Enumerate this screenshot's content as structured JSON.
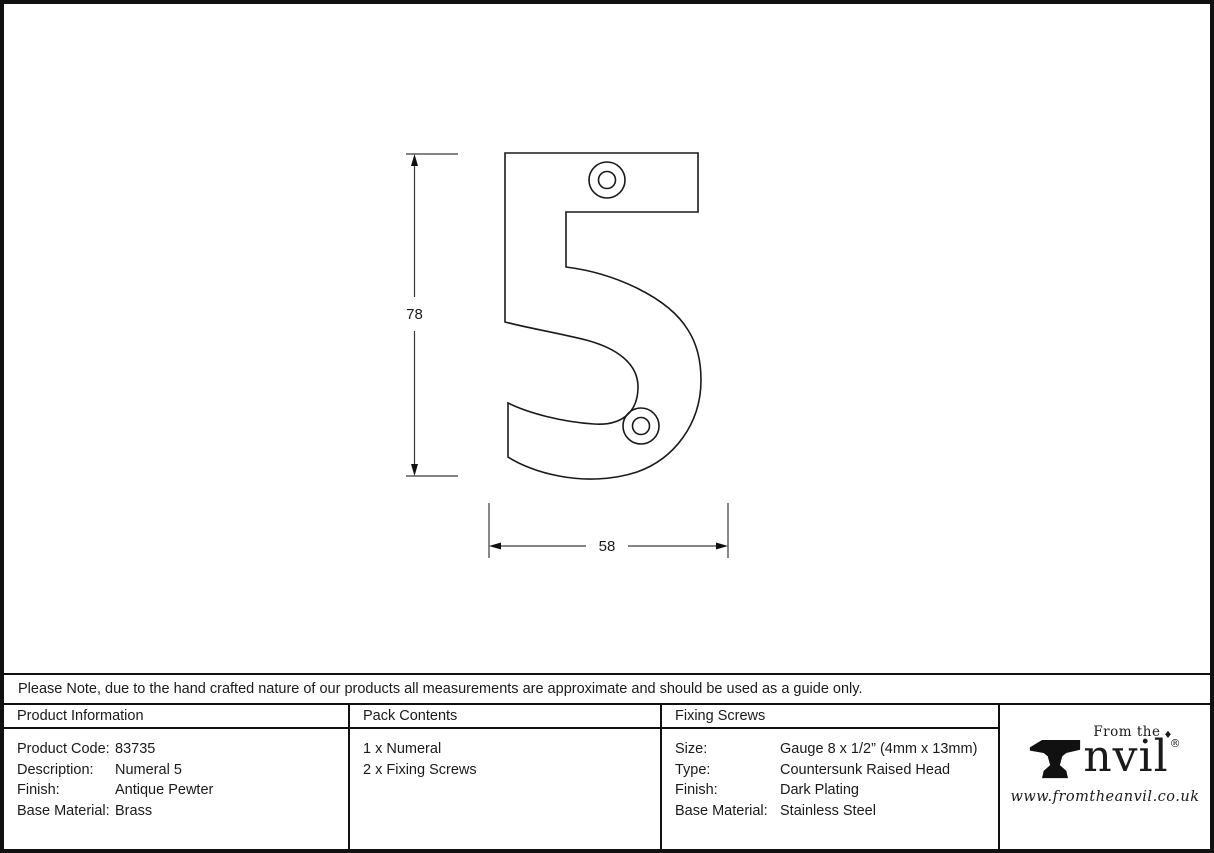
{
  "drawing": {
    "height_label": "78",
    "width_label": "58"
  },
  "note_text": "Please Note, due to the hand crafted nature of our products all measurements are approximate and should be used as a guide only.",
  "table": {
    "product_information": {
      "header": "Product Information",
      "rows": [
        {
          "label": "Product Code:",
          "value": "83735"
        },
        {
          "label": "Description:",
          "value": "Numeral 5"
        },
        {
          "label": "Finish:",
          "value": "Antique Pewter"
        },
        {
          "label": "Base Material:",
          "value": "Brass"
        }
      ]
    },
    "pack_contents": {
      "header": "Pack Contents",
      "items": [
        "1 x Numeral",
        "2 x Fixing Screws"
      ]
    },
    "fixing_screws": {
      "header": "Fixing Screws",
      "rows": [
        {
          "label": "Size:",
          "value": "Gauge 8 x 1/2” (4mm x 13mm)"
        },
        {
          "label": "Type:",
          "value": "Countersunk Raised Head"
        },
        {
          "label": "Finish:",
          "value": "Dark Plating"
        },
        {
          "label": "Base Material:",
          "value": "Stainless Steel"
        }
      ]
    }
  },
  "logo": {
    "from_the": "From the",
    "diamond": "♦",
    "anvil_suffix": "nvil",
    "registered": "®",
    "url": "www.fromtheanvil.co.uk"
  },
  "colors": {
    "ink": "#1a1a1a",
    "dim_line": "#3a3a3a"
  }
}
